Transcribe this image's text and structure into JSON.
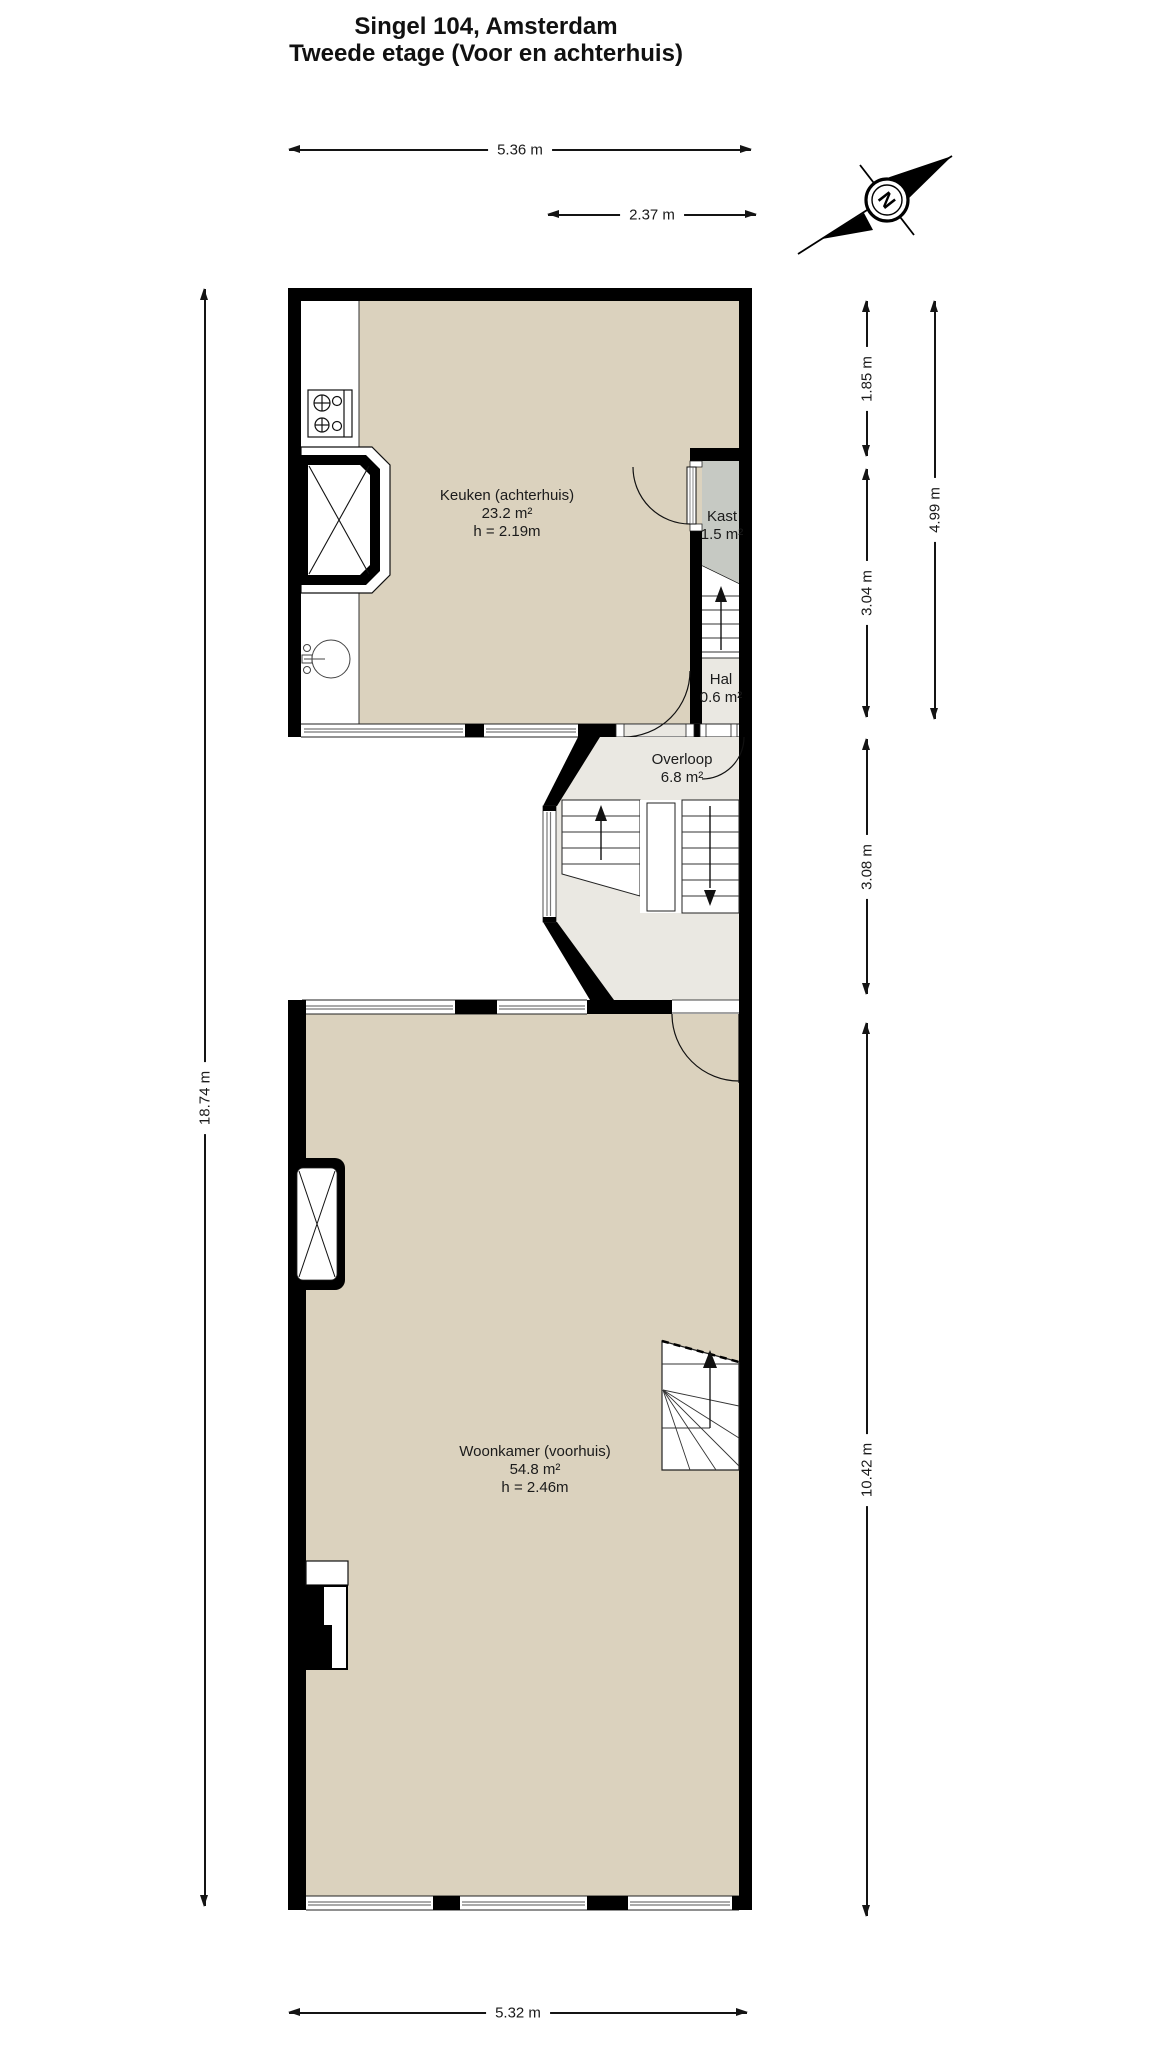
{
  "title": {
    "line1": "Singel 104, Amsterdam",
    "line2": "Tweede etage (Voor en achterhuis)"
  },
  "compass": {
    "label": "N"
  },
  "rooms": {
    "keuken": {
      "name": "Keuken (achterhuis)",
      "area": "23.2 m²",
      "height": "h = 2.19m"
    },
    "kast": {
      "name": "Kast",
      "area": "1.5 m²"
    },
    "hal": {
      "name": "Hal",
      "area": "0.6 m²"
    },
    "overloop": {
      "name": "Overloop",
      "area": "6.8 m²"
    },
    "woonkamer": {
      "name": "Woonkamer (voorhuis)",
      "area": "54.8 m²",
      "height": "h = 2.46m"
    }
  },
  "dimensions": {
    "top_width": "5.36 m",
    "top_right_width": "2.37 m",
    "left_height": "18.74 m",
    "right_upper_first": "1.85 m",
    "right_upper_second": "3.04 m",
    "right_upper_total": "4.99 m",
    "right_middle": "3.08 m",
    "right_lower": "10.42 m",
    "bottom_width": "5.32 m"
  },
  "colors": {
    "wall": "#000000",
    "floor_room": "#DBD2BE",
    "floor_landing": "#EAE8E2",
    "floor_closet": "#C6C9C3",
    "background": "#FFFFFF"
  }
}
